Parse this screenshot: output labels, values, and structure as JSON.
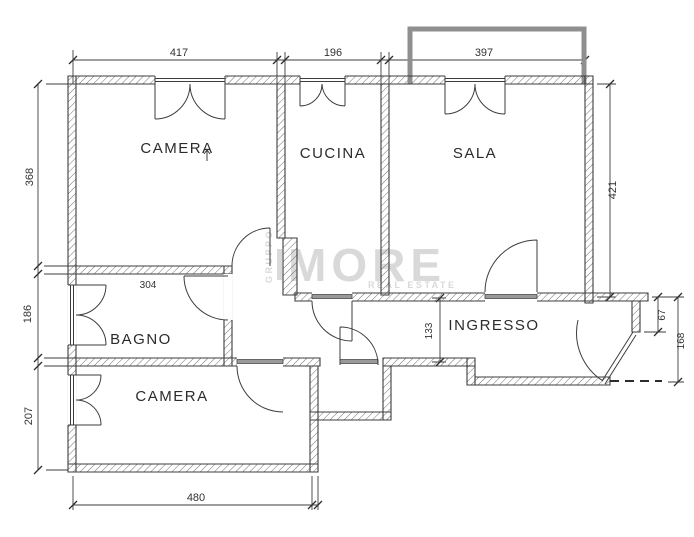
{
  "plan": {
    "title": "apartment-floor-plan",
    "rooms": [
      {
        "id": "camera-top",
        "label": "CAMERA"
      },
      {
        "id": "cucina",
        "label": "CUCINA"
      },
      {
        "id": "sala",
        "label": "SALA"
      },
      {
        "id": "bagno",
        "label": "BAGNO"
      },
      {
        "id": "ingresso",
        "label": "INGRESSO"
      },
      {
        "id": "camera-bottom",
        "label": "CAMERA"
      }
    ],
    "dimensions": {
      "top_camera_width": "417",
      "top_cucina_width": "196",
      "top_sala_width": "397",
      "left_camera_height": "368",
      "left_bagno_height": "186",
      "left_camera2_height": "207",
      "right_sala_height": "421",
      "right_recess_depth": "67",
      "right_entry_height": "168",
      "bagno_width": "304",
      "hall_width": "133",
      "bottom_camera_width": "480"
    },
    "watermark": {
      "group": "GRUPPO",
      "brand": "MORE",
      "tagline": "REAL ESTATE"
    },
    "colors": {
      "wall": "#3d3d3d",
      "line": "#3d3d3d",
      "balcony": "#8f8f8f",
      "watermark": "#d9d9d9",
      "sill": "#9a9a9a",
      "background": "#ffffff"
    }
  }
}
